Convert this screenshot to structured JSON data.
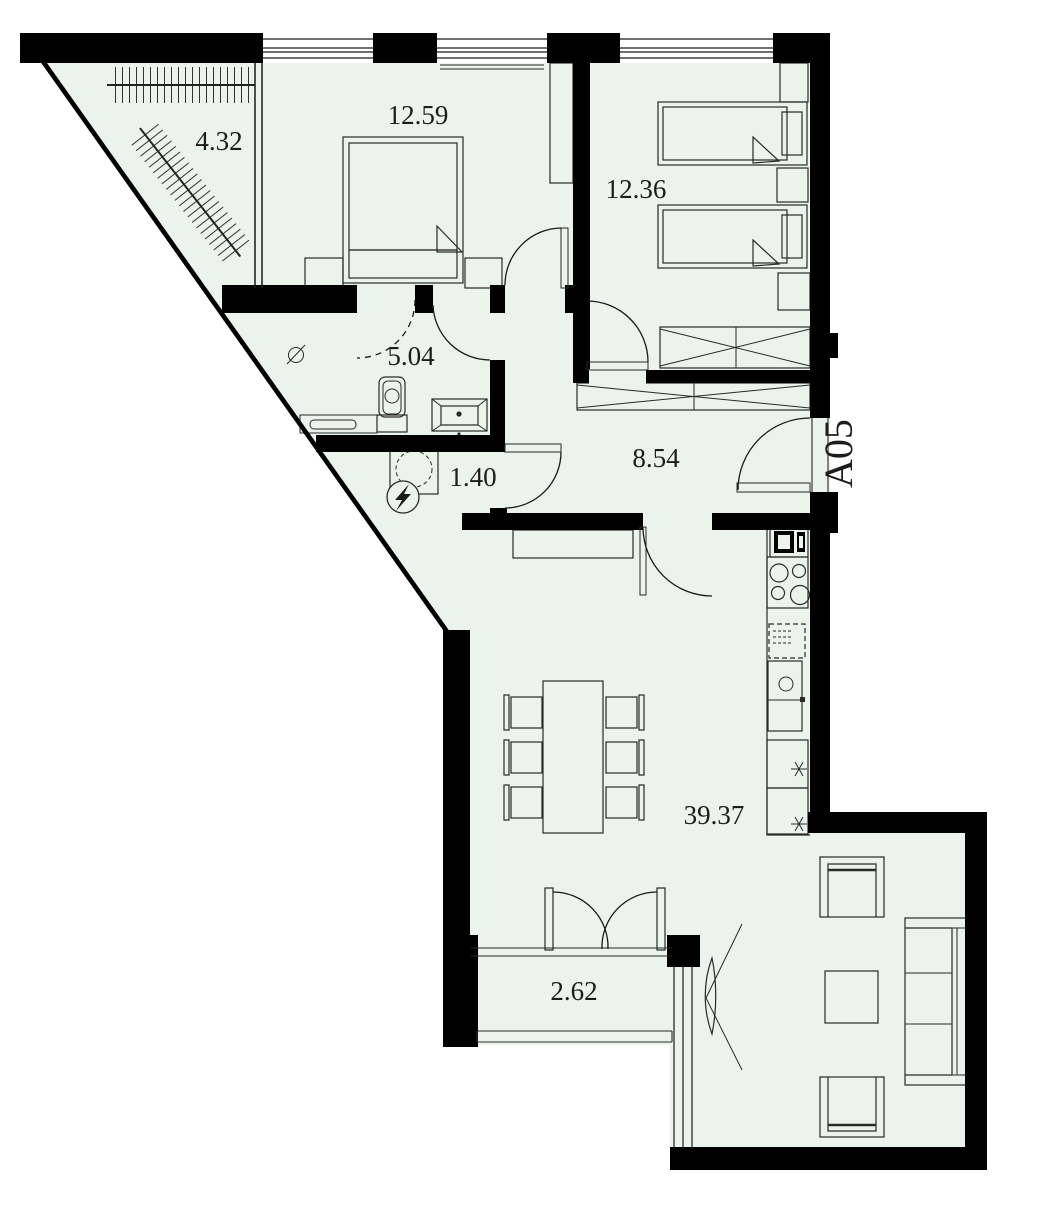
{
  "plan": {
    "apartment_label": "A05",
    "rooms": [
      {
        "name": "wardrobe",
        "area": "4.32"
      },
      {
        "name": "bedroom",
        "area": "12.59"
      },
      {
        "name": "kids-bedroom",
        "area": "12.36"
      },
      {
        "name": "bathroom",
        "area": "5.04"
      },
      {
        "name": "utility",
        "area": "1.40"
      },
      {
        "name": "hallway",
        "area": "8.54"
      },
      {
        "name": "living-kitchen",
        "area": "39.37"
      },
      {
        "name": "balcony",
        "area": "2.62"
      }
    ],
    "colors": {
      "floor": "#eaf3ec",
      "wall": "#000000"
    }
  }
}
